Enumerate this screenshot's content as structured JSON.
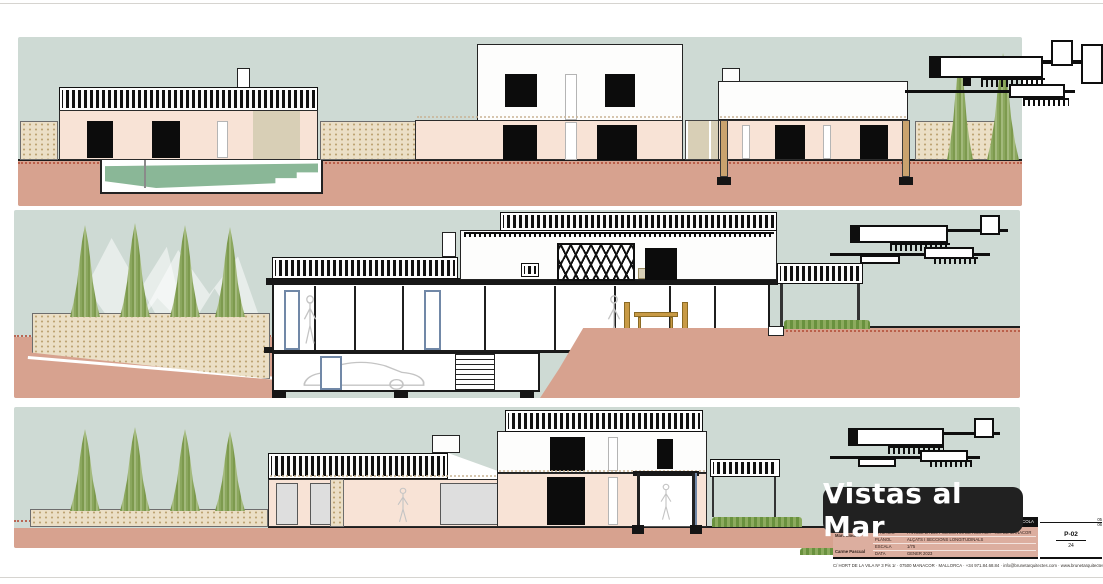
{
  "badge": {
    "label": "Vistas al Mar"
  },
  "title_block": {
    "project_bar": "... I EXPLOTACIÓ AGRÍCOLA",
    "fields": [
      {
        "label": "SITUACIÓ",
        "value": "PARCEL·LA 220 POLIGON 20 DE RÚSTICA - T.M. DE MANACOR"
      },
      {
        "label": "PLÀNOL",
        "value": "ALÇATS I SECCIONS LONGITUDINALS"
      },
      {
        "label": "ESCALA",
        "value": "1/75"
      },
      {
        "label": "DATA",
        "value": "GENER 2023"
      }
    ],
    "authors": [
      "Marc Llodrà",
      "Carme Pascual"
    ],
    "sheet_codes": [
      "05",
      "06",
      "P-02",
      "24"
    ],
    "contact_line": "C/ HORT DE LA VILA Nº 3 Pis 1r · 07500 MANACOR · MALLORCA · +34 971.84.68.84 · info@brunetarquitectes.com · www.brunetarquitectes.com"
  },
  "colors": {
    "sky": "#cedad4",
    "ground": "#d7a28f",
    "facade": "#f8e3d6",
    "stone": "#ebdfc6",
    "cypress": "#8aa55c",
    "pool": "#8ab797",
    "hedge": "#7d9e4d",
    "accent_red": "#b5543e",
    "badge_bg": "#212121",
    "badge_fg": "#ffffff",
    "titleblock_pink": "#dcae9f"
  }
}
